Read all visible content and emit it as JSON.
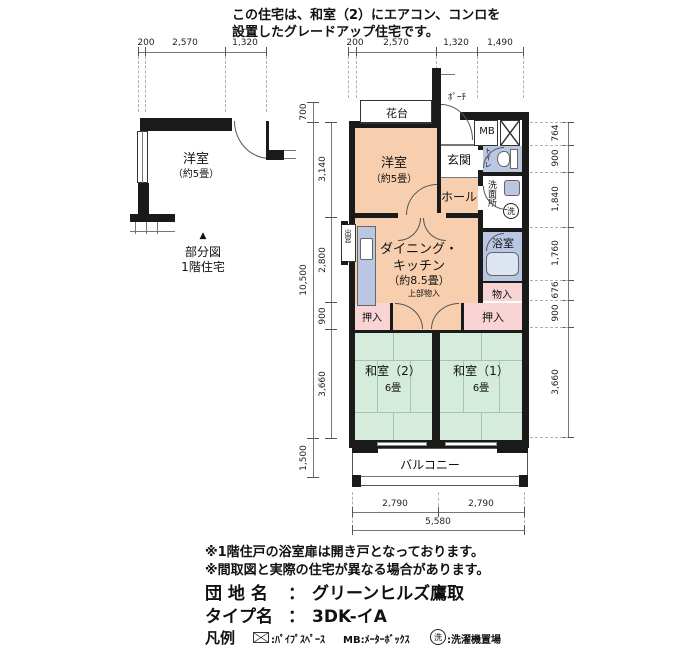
{
  "header": {
    "line1": "この住宅は、和室（2）にエアコン、コンロを",
    "line2": "設置したグレードアップ住宅です。"
  },
  "top_dims": {
    "left": [
      "200",
      "2,570",
      "1,320"
    ],
    "right": [
      "200",
      "2,570",
      "1,320",
      "1,490"
    ]
  },
  "partial": {
    "room": "洋室",
    "room_size": "（約5畳）",
    "marker": "▲",
    "caption1": "部分図",
    "caption2": "1階住宅"
  },
  "plan": {
    "kadai": "花台",
    "porch": "ﾎﾟｰﾁ",
    "mb": "MB",
    "genkan": "玄関",
    "youshitsu": "洋室",
    "youshitsu_size": "（約5畳）",
    "hall": "ホール",
    "toilet": "トイレ",
    "senmenjo": "洗面所",
    "laundry": "洗",
    "bath": "浴室",
    "dk_line1": "ダイニング・",
    "dk_line2": "キッチン",
    "dk_size": "（約8.5畳）",
    "demado": "出窓",
    "jobu_mononyu": "上部物入",
    "mononyu": "物入",
    "oshiire_left": "押入",
    "oshiire_right": "押入",
    "washitsu2": "和室（2）",
    "washitsu2_size": "6畳",
    "washitsu1": "和室（1）",
    "washitsu1_size": "6畳",
    "balcony": "バルコニー"
  },
  "dims_left": {
    "top": "700",
    "overall": "10,500",
    "segments": [
      "3,140",
      "2,800",
      "900",
      "3,660"
    ],
    "bottom": "1,500"
  },
  "dims_right": {
    "segments": [
      "764",
      "900",
      "1,840",
      "1,760",
      "676",
      "900",
      "3,660"
    ]
  },
  "dims_bottom": {
    "halves": [
      "2,790",
      "2,790"
    ],
    "total": "5,580"
  },
  "footer": {
    "note1": "※1階住戸の浴室扉は開き戸となっております。",
    "note2": "※間取図と実際の住宅が異なる場合があります。",
    "estate_label": "団 地 名",
    "estate_sep": "：",
    "estate_value": "グリーンヒルズ鷹取",
    "type_label": "タイプ名",
    "type_sep": "：",
    "type_value": "3DK-イA",
    "legend_label": "凡例",
    "legend_ps": ":ﾊﾟｲﾌﾟｽﾍﾟｰｽ",
    "legend_mb": "MB:ﾒｰﾀｰﾎﾞｯｸｽ",
    "legend_laundry_icon": "洗",
    "legend_laundry": ":洗濯機置場"
  },
  "colors": {
    "peach": "#f7cfae",
    "blue": "#b9c7e2",
    "pink": "#f9d4d4",
    "green": "#d5ebdc",
    "wall": "#1a1a1a"
  }
}
